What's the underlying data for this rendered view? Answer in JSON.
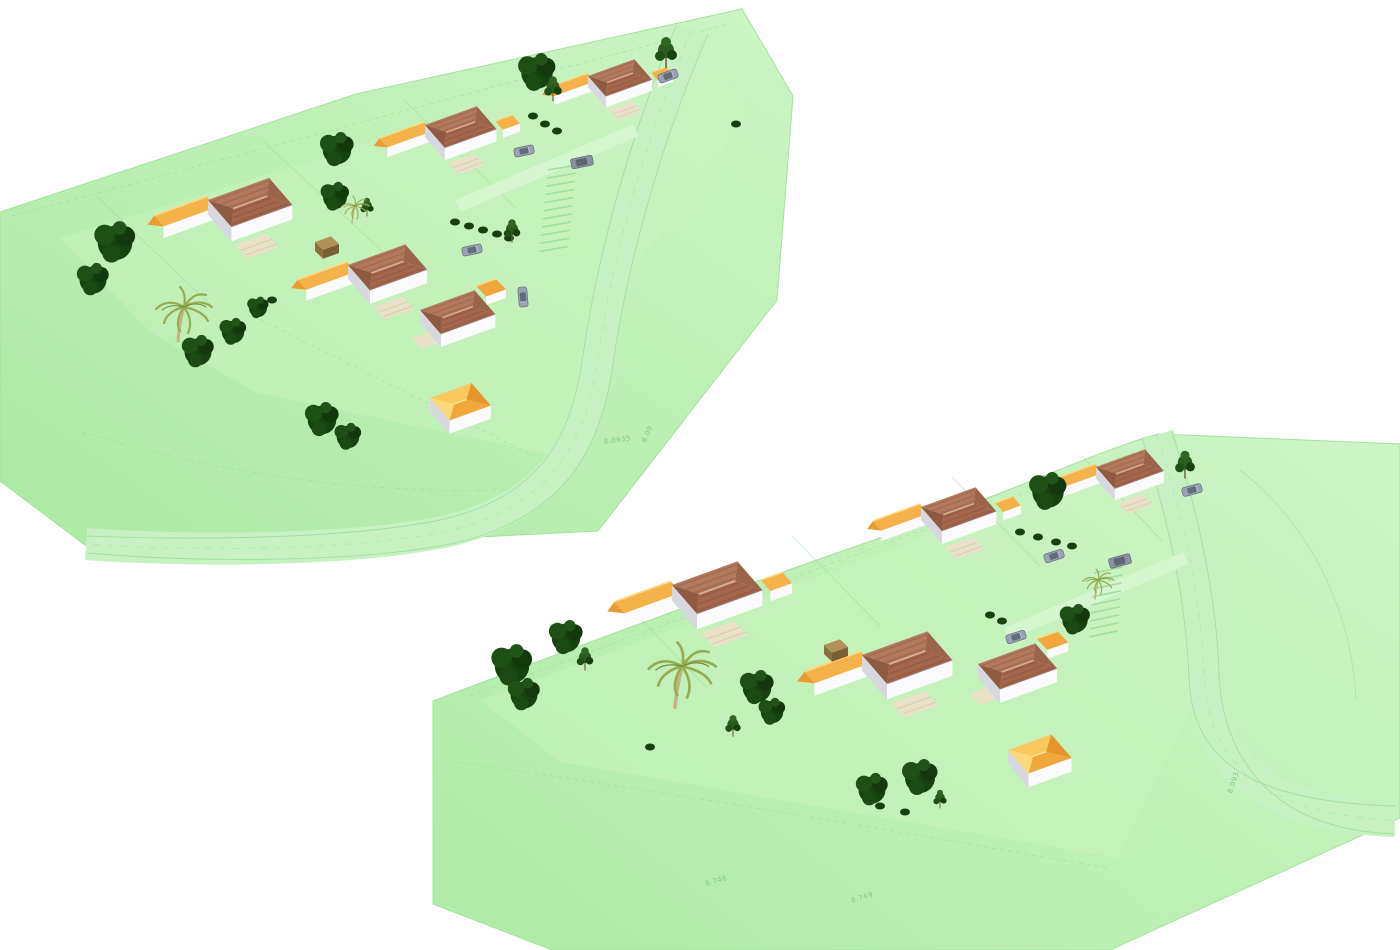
{
  "meta": {
    "description": "Two aerial 3D renderings of a residential site plan on white background",
    "views_count": 2
  },
  "palette": {
    "background": "#ffffff",
    "terrain_dark": "#abe9a2",
    "terrain_light": "#cdf4c6",
    "inner_lawn": "#ccf5c2",
    "road": "#c7f1c2",
    "cad_line": "#8fd98f",
    "hatch_line": "#96dd96",
    "roof_brown_front": "#a4674c",
    "roof_brown_back": "#b3795c",
    "roof_yellow": "#f5b24a",
    "roof_orange": "#f0a73c",
    "wall_white": "#fbfbfd",
    "wall_shade": "#d7d7e0",
    "patio": "#e9e2c8",
    "tree_green": "#17420f",
    "palm_green": "#97ac52",
    "annotation_green": "#7cc47e"
  },
  "scene": {
    "views": [
      {
        "name": "site-view-northwest",
        "terrain": "M0,212 L356,94 L742,9 L793,96 L777,300 L598,531 L420,540 L85,545 L0,481 Z",
        "inner": "M60,238 L700,42 L752,112 L612,298 L576,460 L255,392 L150,332 Z",
        "road": {
          "mid": "M692,30 C642,144 611,264 597,364 C585,442 552,506 448,531 C348,552 186,551 86,544",
          "width": 32,
          "edges": [
            "M676,26 C628,140 596,262 582,362 C570,440 538,498 440,520 C342,540 186,540 86,536",
            "M708,34 C658,150 626,270 612,370 C600,448 566,516 456,543 C352,564 188,562 88,553"
          ]
        },
        "driveways": [
          "M636,130 L458,206"
        ],
        "lines": [
          {
            "d": "M12,216 L728,24",
            "dash": true
          },
          {
            "d": "M96,196 L212,306",
            "dash": false
          },
          {
            "d": "M263,141 L383,252",
            "dash": false
          },
          {
            "d": "M403,99 L516,208",
            "dash": false
          },
          {
            "d": "M253,316 L562,470",
            "dash": true
          },
          {
            "d": "M82,432 C210,472 390,502 562,486",
            "dash": true
          }
        ],
        "parking": {
          "x": 548,
          "y": 170,
          "rotate": 6,
          "count": 11,
          "step": 8.2,
          "len": 28,
          "skew": -8
        },
        "houses": [
          {
            "variant": "b",
            "x": 588,
            "y": 76,
            "s": 0.85
          },
          {
            "variant": "b",
            "x": 425,
            "y": 125,
            "s": 0.95
          },
          {
            "variant": "a",
            "x": 208,
            "y": 200,
            "s": 1.12
          },
          {
            "variant": "a",
            "x": 348,
            "y": 265,
            "s": 1.05
          },
          {
            "variant": "c",
            "x": 420,
            "y": 310,
            "s": 1.0
          },
          {
            "variant": "d",
            "x": 430,
            "y": 398,
            "s": 1.1
          }
        ],
        "vehicles": [
          {
            "type": "car",
            "x": 668,
            "y": 76,
            "r": -20
          },
          {
            "type": "car",
            "x": 524,
            "y": 151,
            "r": -12
          },
          {
            "type": "van",
            "x": 582,
            "y": 162,
            "r": -12
          },
          {
            "type": "car",
            "x": 472,
            "y": 250,
            "r": -12
          },
          {
            "type": "car",
            "x": 523,
            "y": 297,
            "r": 85
          },
          {
            "type": "brownvan",
            "x": 315,
            "y": 242,
            "r": 0
          }
        ],
        "trees": [
          {
            "v": 1,
            "x": 115,
            "y": 243,
            "s": 1.15
          },
          {
            "v": 1,
            "x": 93,
            "y": 280,
            "s": 0.9
          },
          {
            "v": 1,
            "x": 337,
            "y": 150,
            "s": 0.95
          },
          {
            "v": 1,
            "x": 335,
            "y": 197,
            "s": 0.8
          },
          {
            "v": 1,
            "x": 537,
            "y": 73,
            "s": 1.05
          },
          {
            "v": 2,
            "x": 553,
            "y": 90,
            "s": 0.8
          },
          {
            "v": 2,
            "x": 666,
            "y": 54,
            "s": 1.0
          },
          {
            "v": 1,
            "x": 198,
            "y": 352,
            "s": 0.9
          },
          {
            "v": 1,
            "x": 233,
            "y": 332,
            "s": 0.75
          },
          {
            "v": 1,
            "x": 258,
            "y": 308,
            "s": 0.6
          },
          {
            "v": 2,
            "x": 512,
            "y": 232,
            "s": 0.75
          },
          {
            "v": 1,
            "x": 322,
            "y": 420,
            "s": 0.95
          },
          {
            "v": 1,
            "x": 348,
            "y": 437,
            "s": 0.75
          },
          {
            "v": 2,
            "x": 367,
            "y": 208,
            "s": 0.6
          }
        ],
        "palms": [
          {
            "x": 178,
            "y": 325,
            "s": 1.0
          },
          {
            "x": 352,
            "y": 215,
            "s": 0.5
          }
        ],
        "bushes": [
          {
            "x": 533,
            "y": 116
          },
          {
            "x": 545,
            "y": 124
          },
          {
            "x": 557,
            "y": 131
          },
          {
            "x": 455,
            "y": 222
          },
          {
            "x": 469,
            "y": 226
          },
          {
            "x": 483,
            "y": 230
          },
          {
            "x": 497,
            "y": 234
          },
          {
            "x": 509,
            "y": 238
          },
          {
            "x": 736,
            "y": 124
          },
          {
            "x": 272,
            "y": 300
          }
        ],
        "annotations": [
          {
            "text": "8.0935",
            "x": 604,
            "y": 444,
            "r": -8
          },
          {
            "text": "8.09",
            "x": 646,
            "y": 443,
            "r": -68
          }
        ]
      },
      {
        "name": "site-view-southeast",
        "terrain": "M433,701 C520,668 700,600 900,531 C1010,492 1100,450 1158,434 L1400,444 L1400,818 L1110,950 L552,950 L433,904 Z",
        "inner": "M480,700 L1150,455 L1196,560 L1200,688 L1118,858 L560,762 Z",
        "road": {
          "mid": "M1157,435 C1183,515 1201,595 1204,675 C1207,755 1255,815 1395,820",
          "width": 34,
          "edges": [
            "M1142,438 C1168,518 1186,598 1189,678 C1192,752 1238,802 1395,806",
            "M1172,432 C1198,512 1216,592 1219,672 C1222,758 1272,830 1395,834"
          ]
        },
        "driveways": [
          "M1186,558 L1006,634"
        ],
        "lines": [
          {
            "d": "M470,696 L1152,446",
            "dash": true
          },
          {
            "d": "M620,598 L707,688",
            "dash": false
          },
          {
            "d": "M792,536 L880,626",
            "dash": false
          },
          {
            "d": "M952,477 L1040,566",
            "dash": false
          },
          {
            "d": "M1082,456 L1162,541",
            "dash": false
          },
          {
            "d": "M455,762 C700,796 920,836 1108,868",
            "dash": true
          },
          {
            "d": "M1240,470 C1310,525 1352,610 1356,700",
            "dash": false
          }
        ],
        "parking": {
          "x": 1094,
          "y": 573,
          "rotate": 4,
          "count": 9,
          "step": 8,
          "len": 28,
          "skew": -8
        },
        "houses": [
          {
            "variant": "a",
            "x": 1096,
            "y": 467,
            "s": 0.9
          },
          {
            "variant": "b",
            "x": 921,
            "y": 507,
            "s": 1.0
          },
          {
            "variant": "b",
            "x": 672,
            "y": 585,
            "s": 1.2
          },
          {
            "variant": "a",
            "x": 862,
            "y": 655,
            "s": 1.2
          },
          {
            "variant": "c",
            "x": 978,
            "y": 664,
            "s": 1.05
          },
          {
            "variant": "d",
            "x": 1008,
            "y": 750,
            "s": 1.15
          }
        ],
        "vehicles": [
          {
            "type": "car",
            "x": 1192,
            "y": 490,
            "r": -15
          },
          {
            "type": "car",
            "x": 1054,
            "y": 556,
            "r": -18
          },
          {
            "type": "van",
            "x": 1120,
            "y": 561,
            "r": -15
          },
          {
            "type": "car",
            "x": 1016,
            "y": 637,
            "r": -18
          },
          {
            "type": "brownvan",
            "x": 824,
            "y": 645,
            "r": 0
          }
        ],
        "trees": [
          {
            "v": 1,
            "x": 512,
            "y": 666,
            "s": 1.15
          },
          {
            "v": 1,
            "x": 524,
            "y": 695,
            "s": 0.9
          },
          {
            "v": 1,
            "x": 566,
            "y": 638,
            "s": 0.95
          },
          {
            "v": 2,
            "x": 585,
            "y": 660,
            "s": 0.75
          },
          {
            "v": 1,
            "x": 757,
            "y": 688,
            "s": 0.95
          },
          {
            "v": 1,
            "x": 772,
            "y": 712,
            "s": 0.75
          },
          {
            "v": 2,
            "x": 733,
            "y": 727,
            "s": 0.7
          },
          {
            "v": 1,
            "x": 872,
            "y": 790,
            "s": 0.9
          },
          {
            "v": 1,
            "x": 920,
            "y": 778,
            "s": 1.0
          },
          {
            "v": 1,
            "x": 1048,
            "y": 492,
            "s": 1.05
          },
          {
            "v": 2,
            "x": 1185,
            "y": 466,
            "s": 0.9
          },
          {
            "v": 1,
            "x": 1075,
            "y": 620,
            "s": 0.85
          },
          {
            "v": 2,
            "x": 940,
            "y": 800,
            "s": 0.6
          }
        ],
        "palms": [
          {
            "x": 675,
            "y": 688,
            "s": 1.2
          },
          {
            "x": 1095,
            "y": 590,
            "s": 0.55
          }
        ],
        "bushes": [
          {
            "x": 1020,
            "y": 532
          },
          {
            "x": 1038,
            "y": 537
          },
          {
            "x": 1056,
            "y": 542
          },
          {
            "x": 1072,
            "y": 546
          },
          {
            "x": 990,
            "y": 615
          },
          {
            "x": 1002,
            "y": 621
          },
          {
            "x": 880,
            "y": 806
          },
          {
            "x": 650,
            "y": 747
          },
          {
            "x": 905,
            "y": 812
          }
        ],
        "annotations": [
          {
            "text": "8.746",
            "x": 706,
            "y": 886,
            "r": -16
          },
          {
            "text": "8.749",
            "x": 852,
            "y": 903,
            "r": -18
          },
          {
            "text": "8.093",
            "x": 1232,
            "y": 794,
            "r": -72
          }
        ]
      }
    ]
  }
}
